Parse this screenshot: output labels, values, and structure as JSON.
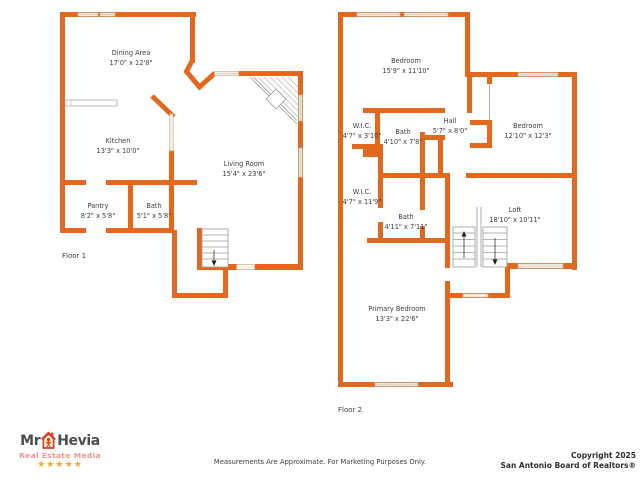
{
  "colors": {
    "wall": "#e2681e",
    "win_fill": "#f9f1e4",
    "win_stroke": "#bfb6a6",
    "line": "#9a9a9a",
    "text": "#3d3d3d",
    "copy": "#2e2e2e",
    "logo_dark": "#4d4d4d",
    "logo_red": "#d8402a",
    "logo_salmon": "#f0958a",
    "star_gold": "#f2a71b"
  },
  "floor1": {
    "label": "Floor 1",
    "rooms": {
      "dining": {
        "name": "Dining Area",
        "dims": "17'0\" x 12'8\""
      },
      "kitchen": {
        "name": "Kitchen",
        "dims": "13'3\" x 10'0\""
      },
      "living": {
        "name": "Living Room",
        "dims": "15'4\" x 23'6\""
      },
      "pantry": {
        "name": "Pantry",
        "dims": "8'2\" x 5'8\""
      },
      "bath": {
        "name": "Bath",
        "dims": "5'1\" x 5'8\""
      }
    }
  },
  "floor2": {
    "label": "Floor 2",
    "rooms": {
      "bedroom_top": {
        "name": "Bedroom",
        "dims": "15'9\" x 11'10\""
      },
      "wic_upper": {
        "name": "W.I.C.",
        "dims": "4'7\" x 3'10\""
      },
      "bath_upper": {
        "name": "Bath",
        "dims": "4'10\" x 7'8\""
      },
      "hall": {
        "name": "Hall",
        "dims": "5'7\" x 8'0\""
      },
      "bedroom_right": {
        "name": "Bedroom",
        "dims": "12'10\" x 12'3\""
      },
      "wic_lower": {
        "name": "W.I.C.",
        "dims": "4'7\" x 11'9\""
      },
      "bath_lower": {
        "name": "Bath",
        "dims": "4'11\" x 7'11\""
      },
      "loft": {
        "name": "Loft",
        "dims": "18'10\" x 10'11\""
      },
      "primary": {
        "name": "Primary Bedroom",
        "dims": "13'3\" x 22'6\""
      }
    }
  },
  "footer": {
    "disclaimer": "Measurements Are Approximate. For Marketing Purposes Only.",
    "copyright_line1": "Copyright 2025",
    "copyright_line2": "San Antonio Board of Realtors®"
  },
  "logo": {
    "name_prefix": "Mr",
    "name_suffix": "Hevia",
    "tagline": "Real Estate Media",
    "stars": "★★★★★"
  }
}
